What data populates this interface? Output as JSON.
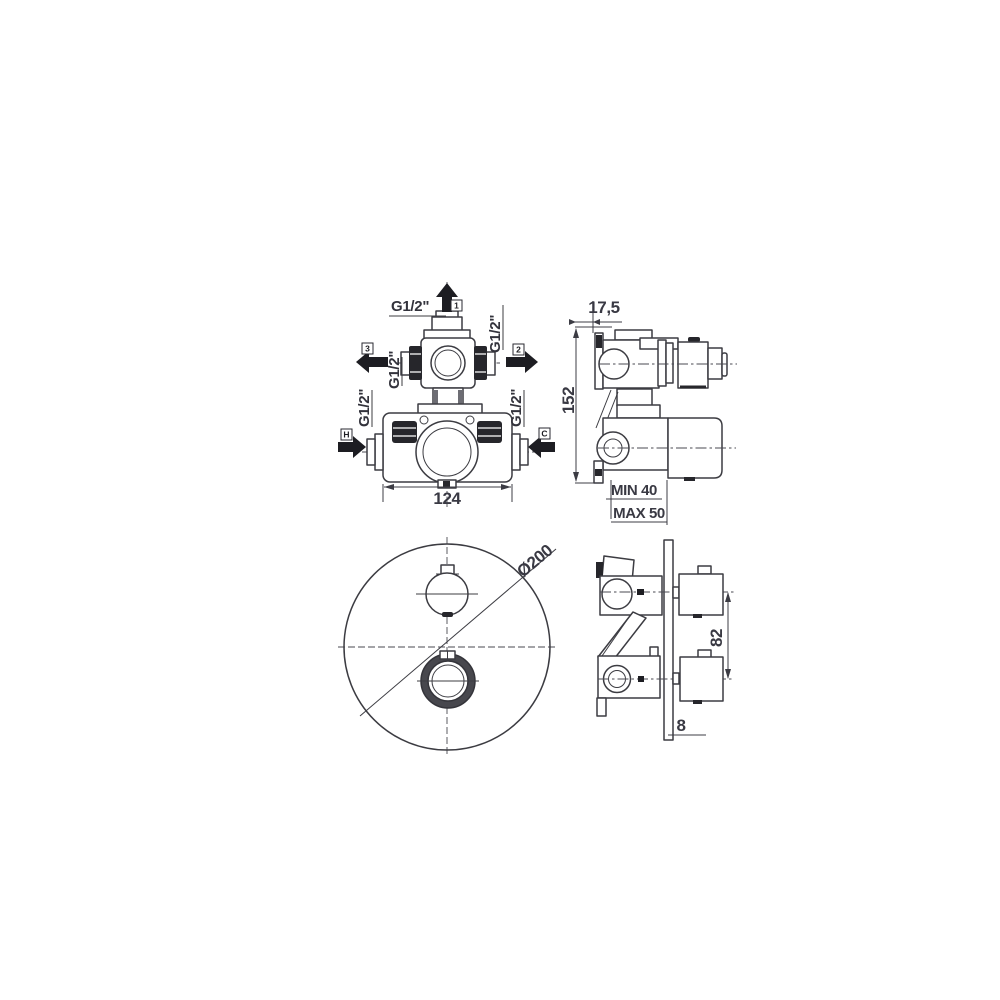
{
  "drawing": {
    "front_view": {
      "dim_width": "124",
      "ports": [
        {
          "tag": "1",
          "thread": "G1/2\""
        },
        {
          "tag": "2",
          "thread": "G1/2\""
        },
        {
          "tag": "3",
          "thread": "G1/2\""
        },
        {
          "tag": "H",
          "thread": "G1/2\""
        },
        {
          "tag": "C",
          "thread": "G1/2\""
        }
      ]
    },
    "side_view": {
      "dim_offset": "17,5",
      "dim_height": "152",
      "dim_min_depth": "MIN 40",
      "dim_max_depth": "MAX 50"
    },
    "plate_view": {
      "dim_diameter": "Ø200"
    },
    "installed_view": {
      "dim_centers": "82",
      "dim_plate": "8"
    }
  }
}
